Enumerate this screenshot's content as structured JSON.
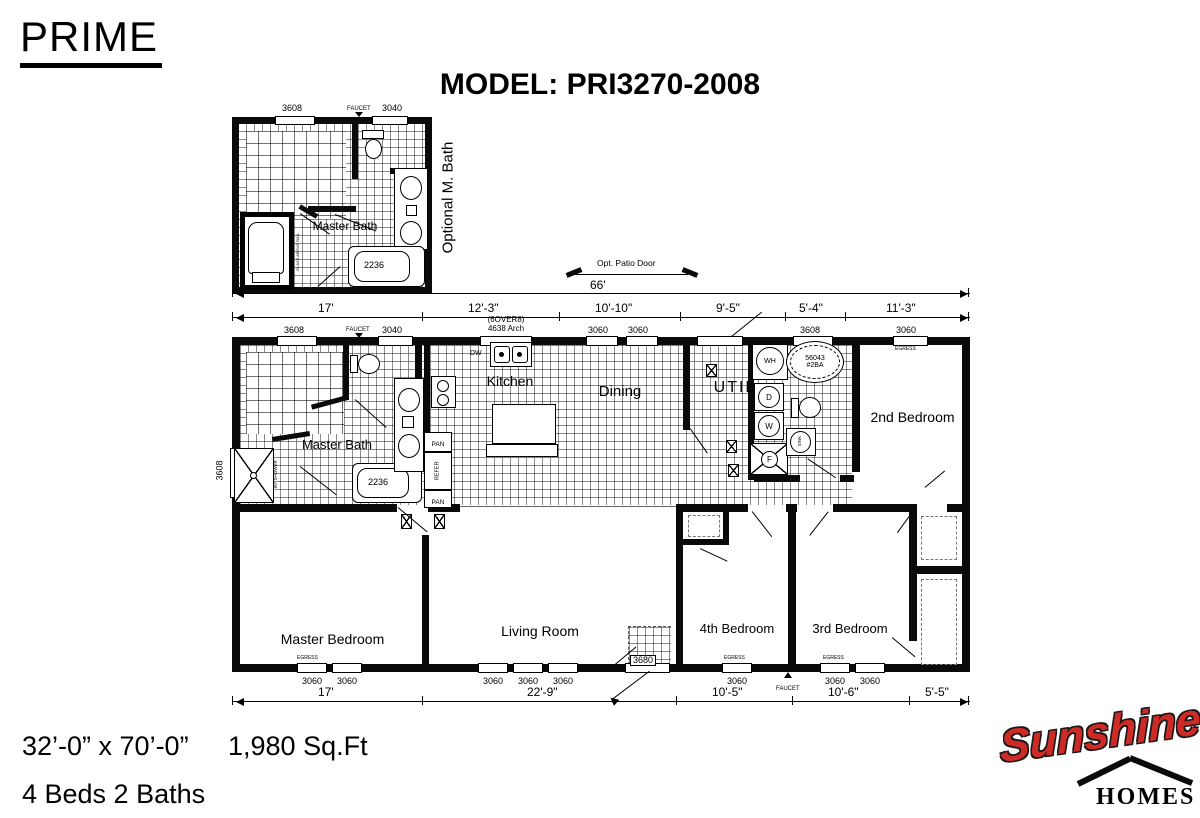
{
  "header": {
    "brand": "PRIME",
    "model": "MODEL: PRI3270-2008"
  },
  "inset": {
    "win_left": "3608",
    "faucet": "FAUCET",
    "win_right": "3040",
    "room": "Master Bath",
    "tub": "2236",
    "side": "Optional M. Bath",
    "glass_note": "GLASS ABOVE RAIL"
  },
  "dims": {
    "top": {
      "overall": "66'",
      "patio_note": "Opt. Patio Door",
      "segments": [
        "17'",
        "12'-3\"",
        "10'-10\"",
        "9'-5\"",
        "5'-4\"",
        "11'-3\""
      ]
    },
    "bottom": {
      "segments": [
        "17'",
        "22'-9\"",
        "10'-5\"",
        "10'-6\"",
        "5'-5\""
      ]
    }
  },
  "wt": {
    "w1": "3608",
    "faucet": "FAUCET",
    "w2": "3040",
    "arch1": "(6OVER8)",
    "arch2": "4638 Arch",
    "w3": "3060",
    "w4": "3060",
    "w5": "3680",
    "w6": "3608",
    "w7": "3060"
  },
  "wb": {
    "mb1": "3060",
    "mb2": "3060",
    "lr1": "3060",
    "lr2": "3060",
    "lr3": "3060",
    "patio": "3680",
    "b4": "3060",
    "faucet": "FAUCET",
    "b3a": "3060",
    "b3b": "3060"
  },
  "wl": {
    "left": "3608"
  },
  "plan": {
    "egress": "EGRESS"
  },
  "rooms": {
    "master_bath": "Master Bath",
    "kitchen": "Kitchen",
    "dining": "Dining",
    "util": "UTIL",
    "bedroom2": "2nd Bedroom",
    "master_bedroom": "Master Bedroom",
    "living": "Living Room",
    "bedroom4": "4th Bedroom",
    "bedroom3": "3rd Bedroom"
  },
  "fix": {
    "tub": "2236",
    "shower": "60\" SHOWER",
    "dw": "DW",
    "pan": "PAN",
    "refer": "REFER",
    "wh": "WH",
    "dryer": "D",
    "washer": "W",
    "furnace": "F",
    "gtub1": "56043",
    "gtub2": "#2BA",
    "sink": "SINK"
  },
  "footer": {
    "size": "32’-0” x 70’-0”",
    "area": "1,980 Sq.Ft",
    "beds_baths": "4 Beds 2 Baths"
  },
  "logo": {
    "name": "Sunshine",
    "sub": "HOMES",
    "red": "#cf2b26"
  }
}
